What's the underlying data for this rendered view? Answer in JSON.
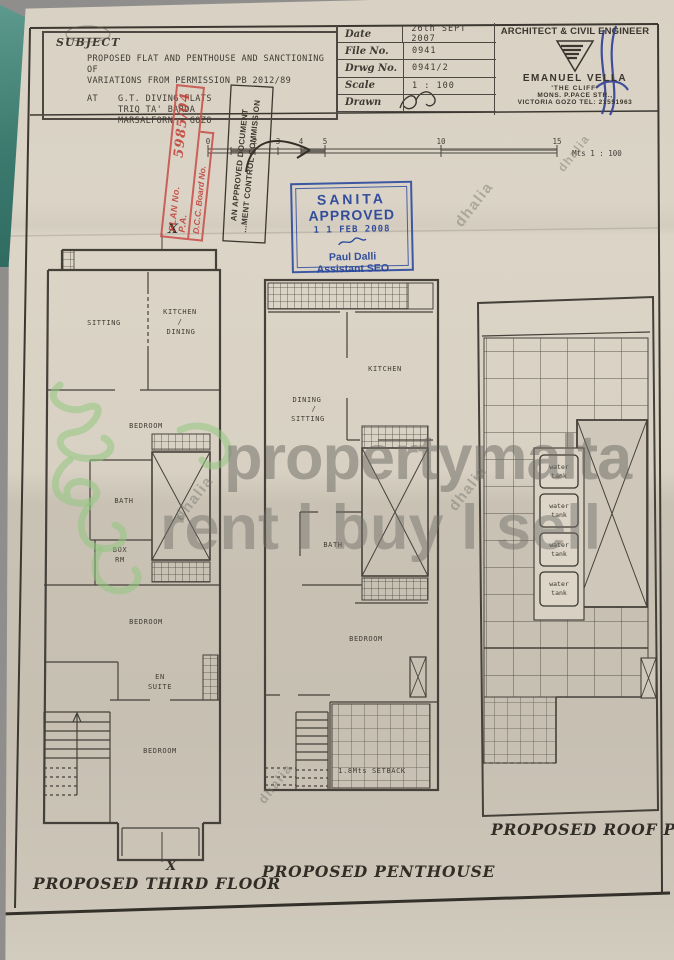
{
  "subject": {
    "heading": "SUBJECT",
    "line1": "PROPOSED FLAT AND PENTHOUSE AND SANCTIONING OF",
    "line2": "VARIATIONS FROM PERMISSION PB 2012/89",
    "at_label": "AT",
    "at_line1": "G.T. DIVING FLATS",
    "at_line2": "TRIQ TA' BARDA",
    "at_line3": "MARSALFORN - GOZO"
  },
  "title_block": {
    "rows": [
      {
        "label": "Date",
        "value": "26th SEPT 2007"
      },
      {
        "label": "File No.",
        "value": "0941"
      },
      {
        "label": "Drwg No.",
        "value": "0941/2"
      },
      {
        "label": "Scale",
        "value": "1 : 100"
      },
      {
        "label": "Drawn",
        "value": ""
      }
    ],
    "architect": {
      "heading": "ARCHITECT & CIVIL ENGINEER",
      "name": "EMANUEL VELLA",
      "address_line1": "'THE CLIFF'",
      "address_line2": "MONS. P.PACE STR.,",
      "address_line3": "VICTORIA GOZO TEL: 21551963"
    }
  },
  "stamps": {
    "red": {
      "line1_label": "PLAN No. P.A.",
      "line1_value": "5985/04",
      "line2": "D.C.C. Board No."
    },
    "approved_doc": {
      "line1": "AN APPROVED DOCUMENT",
      "line2": "...MENT CONTROL COMMISSION"
    },
    "sanita": {
      "line1": "SANITA",
      "line2": "APPROVED",
      "date": "1 1 FEB 2008",
      "name": "Paul Dalli",
      "role": "Assistant SEO"
    }
  },
  "scale_bar": {
    "ticks": [
      "0",
      "2",
      "3",
      "4",
      "5",
      "10",
      "15"
    ],
    "unit": "Mts 1 : 100"
  },
  "plans": {
    "third_floor": {
      "title": "PROPOSED THIRD FLOOR",
      "sitting": "SITTING",
      "kitchen1": "KITCHEN",
      "kitchen2": "/",
      "kitchen3": "DINING",
      "bedroom_a": "BEDROOM",
      "bath": "BATH",
      "box1": "BOX",
      "box2": "RM",
      "bedroom_b": "BEDROOM",
      "ensuite1": "EN",
      "ensuite2": "SUITE",
      "bedroom_c": "BEDROOM",
      "section_top": "X",
      "section_bottom": "X"
    },
    "penthouse": {
      "title": "PROPOSED PENTHOUSE",
      "kitchen": "KITCHEN",
      "dining1": "DINING",
      "dining2": "/",
      "dining3": "SITTING",
      "bath": "BATH",
      "bedroom": "BEDROOM",
      "setback": "1.8Mts SETBACK"
    },
    "roof": {
      "title": "PROPOSED ROOF PLAN",
      "tank_line1": "water",
      "tank_line2": "tank"
    }
  },
  "watermarks": {
    "line1": "propertymalta",
    "line2": "rent l buy l sell",
    "brand": "dhalia"
  },
  "colors": {
    "paper": "#d8d1c3",
    "ink": "#453f38",
    "stamp_blue": "#2b4a9e",
    "stamp_red": "#c0413b",
    "folder_teal": "#3f7d72",
    "watermark_gray": "#6e6c67",
    "watermark_green": "#8fc47e"
  }
}
